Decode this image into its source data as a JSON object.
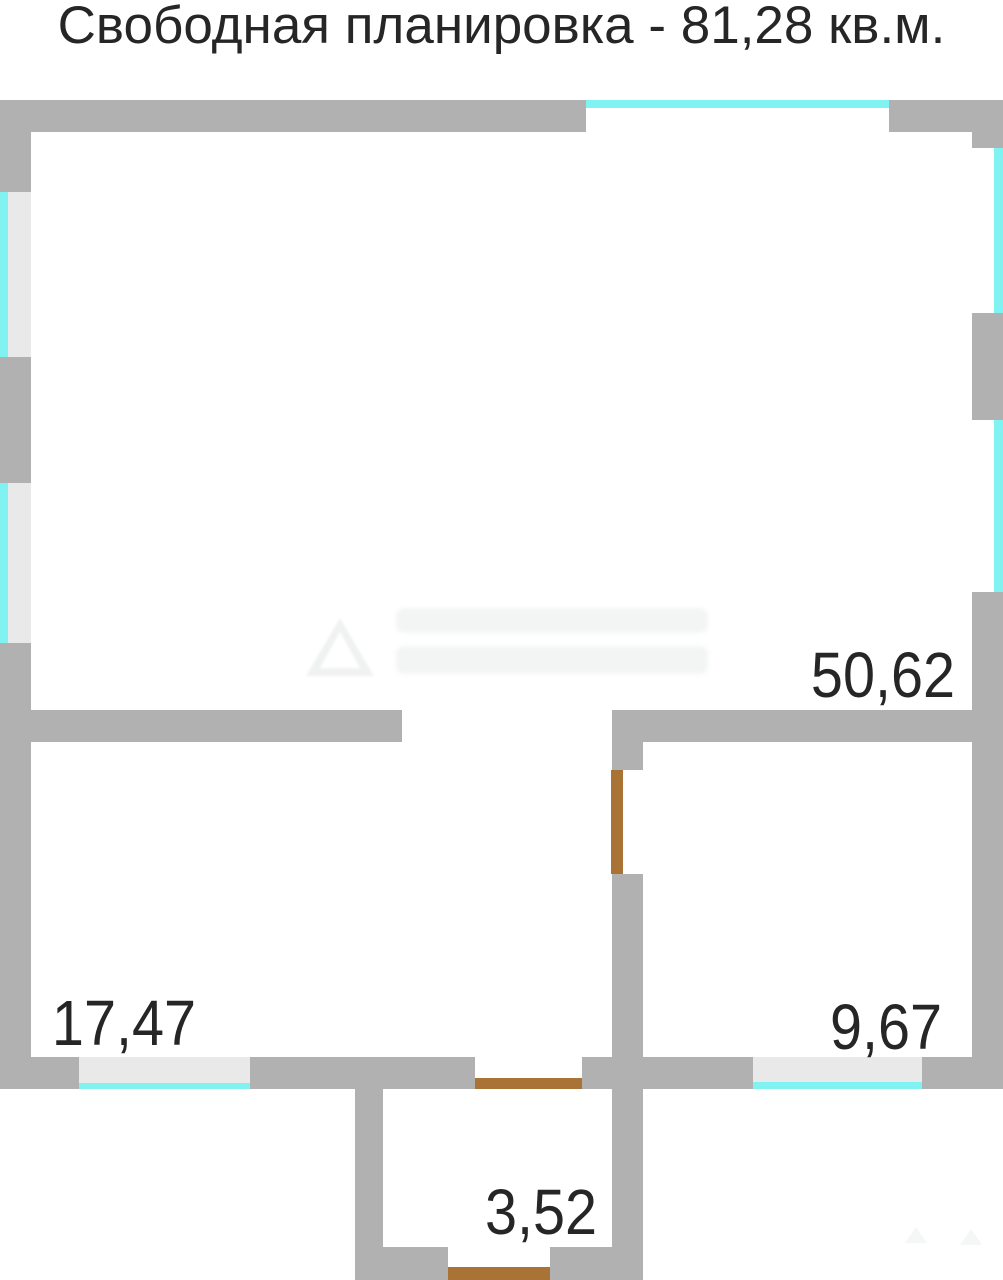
{
  "title": "Свободная планировка - 81,28 кв.м.",
  "plan": {
    "rooms": [
      {
        "id": "main-room",
        "area_label": "50,62"
      },
      {
        "id": "left-room",
        "area_label": "17,47"
      },
      {
        "id": "right-room",
        "area_label": "9,67"
      },
      {
        "id": "vestibule",
        "area_label": "3,52"
      }
    ]
  },
  "icons": {
    "watermark_logo": "triangle-logo",
    "watermark_mini": "triangle-mini"
  },
  "colors": {
    "wall": "#b1b1b1",
    "glass": "#80f2f2",
    "window_fill": "#e9e9e9",
    "door": "#a97335",
    "text": "#262626",
    "watermark": "#f0f2f2"
  }
}
